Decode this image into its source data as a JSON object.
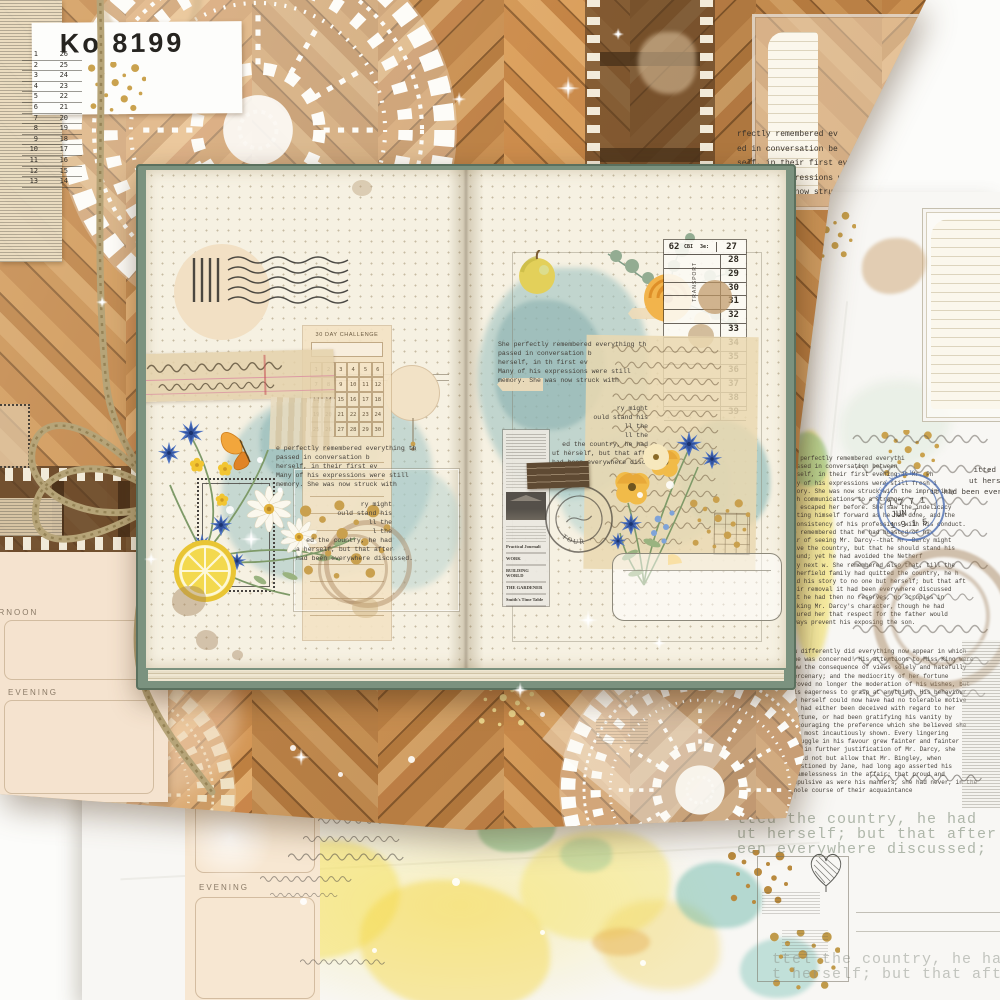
{
  "ticket": {
    "code": "Ko 8199",
    "rows": [
      {
        "l": "1",
        "r": "26"
      },
      {
        "l": "2",
        "r": "25"
      },
      {
        "l": "3",
        "r": "24"
      },
      {
        "l": "4",
        "r": "23"
      },
      {
        "l": "5",
        "r": "22"
      },
      {
        "l": "6",
        "r": "21"
      },
      {
        "l": "7",
        "r": "20"
      },
      {
        "l": "8",
        "r": "19"
      },
      {
        "l": "9",
        "r": "18"
      },
      {
        "l": "10",
        "r": "17"
      },
      {
        "l": "11",
        "r": "16"
      },
      {
        "l": "12",
        "r": "15"
      },
      {
        "l": "13",
        "r": "14"
      }
    ]
  },
  "wood_typed": {
    "lines": [
      "rfectly remembered ev",
      "ed in conversation be",
      "self, in their first eve",
      "g of his expressions were",
      "ry. She was now struck w"
    ]
  },
  "planner_wood": {
    "afternoon": "AFTERNOON",
    "evening": "EVENING"
  },
  "planner_sheet2": {
    "evening": "EVENING"
  },
  "challenge": {
    "title": "30 DAY CHALLENGE",
    "numbers": [
      "1",
      "2",
      "3",
      "4",
      "5",
      "6",
      "7",
      "8",
      "9",
      "10",
      "11",
      "12",
      "13",
      "14",
      "15",
      "16",
      "17",
      "18",
      "19",
      "20",
      "21",
      "22",
      "23",
      "24",
      "25",
      "26",
      "27",
      "28",
      "29",
      "30"
    ]
  },
  "ledger": {
    "left": "62",
    "mid": "CBI",
    "mid2": "3e:",
    "right": "27",
    "rows": [
      "28",
      "29",
      "30",
      "31",
      "32",
      "33",
      "34",
      "35",
      "36",
      "37",
      "38",
      "39"
    ],
    "vertical": "TRANSPORT"
  },
  "typed_a": {
    "lines": [
      "e perfectly remembered everything th",
      "passed in conversation b",
      "herself, in their first ev",
      "Many of his expressions were still",
      "memory. She was now struck with"
    ]
  },
  "typed_b": {
    "lines": [
      "ry might",
      "ould stand his",
      "ll the",
      "l the",
      "ed the country, he had",
      "a herself, but that after",
      "had been everywhere discussed."
    ]
  },
  "typed_c": {
    "lines": [
      "She perfectly remembered everything th",
      "passed in conversation b",
      "herself, in th   first ev",
      "Many of his expressions were still",
      "memory. She was now struck with"
    ]
  },
  "typed_d": {
    "lines": [
      "ry might",
      "ould stand his",
      "ll the",
      "ll the",
      "ed the country, he had",
      "ut herself, but that after",
      "had been everywhere discussed."
    ]
  },
  "postmark": {
    "ring": "T O U R"
  },
  "newspaper": {
    "entries": [
      "Practical Journali",
      "WORK",
      "BUILDING WORLD",
      "THE GARDENER",
      "Smith's Time Table"
    ]
  },
  "blue_stamp": {
    "ring": "N E W   Y O R K",
    "lines": [
      "1 7 7 1",
      "JUN 7",
      "1 9 1 5"
    ]
  },
  "s2_para1": {
    "lines": [
      "e perfectly remembered everythi",
      "assed in conversation between",
      "rself, in their first evening at Mr. Ph",
      "ny of his expressions were still fresh i",
      "mory. She was now struck with the impropriety",
      "ch communications to a stranger",
      "d escaped her before. She saw the indelicacy",
      "tting himself forward as he had done, and the",
      "consistency of his professions with his conduct.",
      "e remembered that he had boasted of ha",
      "ar of seeing Mr. Darcy--that Mr. Darcy might",
      "ave the country, but that he should stand his",
      "ound; yet he had avoided the Netherf",
      "ry next w.  She remembered also that, till the",
      "therfield family had quitted the country, he h",
      "ld his story to no one but herself; but that aft",
      "eir removal it had been everywhere discussed",
      "at he had then no reserves, no scruples in",
      "nking Mr. Darcy's character, though he had",
      "sured her that respect for the father would",
      "ways prevent his exposing the son."
    ]
  },
  "s2_para2": {
    "lines": [
      "ow differently did everything now appear in which",
      "she was concerned! His attentions to Miss King were",
      "now the consequence of views solely and hatefully",
      "mercenary; and the mediocrity of her fortune",
      "proved no longer the moderation of his wishes, but",
      "his eagerness to grasp at anything. His behaviour",
      "to herself could now have had no tolerable motive",
      "he had either been deceived with regard to her",
      "fortune, or had been gratifying his vanity by",
      "encouraging the preference which she believed she",
      "had most incautiously shown. Every lingering",
      "struggle in his favour grew fainter and fainter",
      "and in further justification of Mr. Darcy, she",
      "could not but allow that Mr. Bingley, when",
      "questioned by Jane, had long ago asserted his",
      "blamelessness in the affair; that proud and",
      "repulsive as were his manners, she had never, in the",
      "whole course of their acquaintance"
    ]
  },
  "s2_edge": {
    "lines": [
      "itted t",
      "ut herse",
      "it had been everyw"
    ]
  },
  "faded_mid": {
    "lines": [
      "tted the country, he had",
      "ut herself; but that after",
      "een everywhere discussed;"
    ]
  },
  "faded_bottom": {
    "lines": [
      "ttel the country, he had",
      "t herself; but that after"
    ]
  },
  "colors": {
    "wood": "#c3874b",
    "teal": "#9fc3c2",
    "yellow": "#f5df55",
    "sage_cover": "#7b927f",
    "cream": "#f3e6cd",
    "gold": "#c09a4a",
    "blue_flower": "#4e73c2",
    "stamp_blue": "#4a6cb0"
  }
}
